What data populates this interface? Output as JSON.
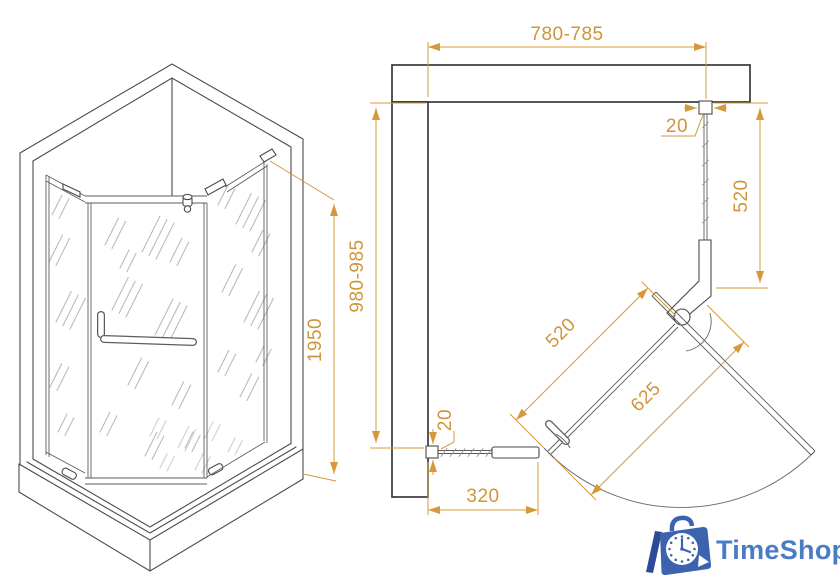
{
  "drawing": {
    "iso_view": {
      "height": "1950"
    },
    "plan_view": {
      "top_width": "780-785",
      "side_depth": "980-985",
      "right_panel": "520",
      "diagonal_panel": "520",
      "door_width": "625",
      "bottom_panel": "320",
      "top_wall_gap": "20",
      "bottom_wall_gap": "20"
    }
  },
  "logo": {
    "text": "TimeShop"
  },
  "colors": {
    "dimension_orange": "#d5983b",
    "drawing_line": "#4a4a4a",
    "logo_blue": "#4a7cc4",
    "logo_icon_blue": "#3c63ad",
    "hatch_gray": "#b6bcc4"
  }
}
